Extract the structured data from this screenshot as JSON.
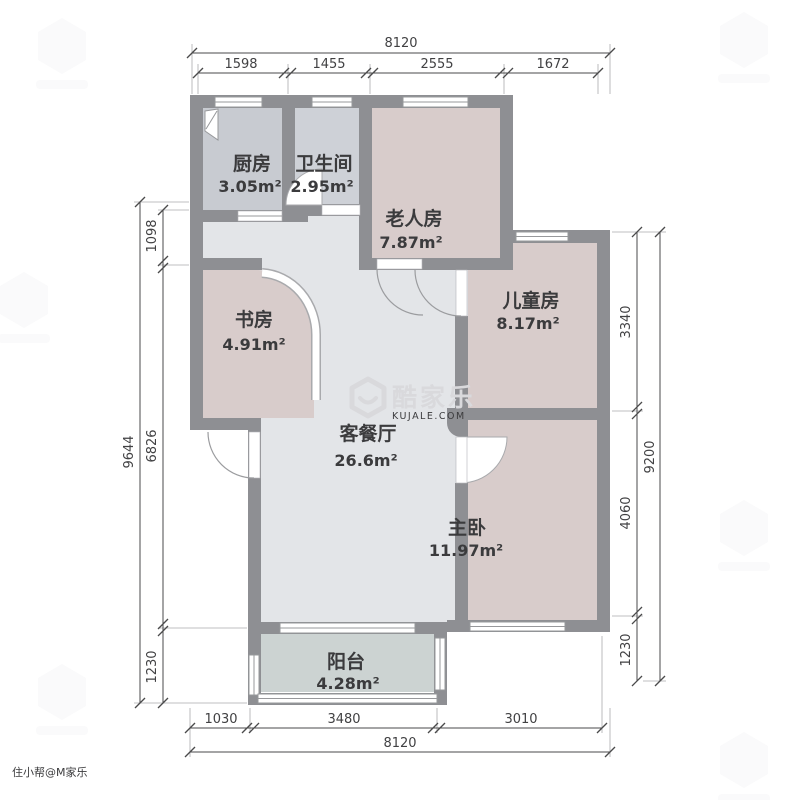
{
  "title": "户型图",
  "rooms": [
    {
      "id": "kitchen",
      "name": "厨房",
      "area": "3.05m²"
    },
    {
      "id": "bathroom",
      "name": "卫生间",
      "area": "2.95m²"
    },
    {
      "id": "elder-room",
      "name": "老人房",
      "area": "7.87m²"
    },
    {
      "id": "kids-room",
      "name": "儿童房",
      "area": "8.17m²"
    },
    {
      "id": "study",
      "name": "书房",
      "area": "4.91m²"
    },
    {
      "id": "living-dining",
      "name": "客餐厅",
      "area": "26.6m²"
    },
    {
      "id": "master-bedroom",
      "name": "主卧",
      "area": "11.97m²"
    },
    {
      "id": "balcony",
      "name": "阳台",
      "area": "4.28m²"
    }
  ],
  "dimensions_mm": {
    "top": {
      "total": "8120",
      "segments": [
        "1598",
        "1455",
        "2555",
        "1672"
      ]
    },
    "bottom": {
      "total": "8120",
      "segments": [
        "1030",
        "3480",
        "3010"
      ]
    },
    "left": {
      "total": "9644",
      "segments": [
        "1098",
        "6826",
        "1230"
      ]
    },
    "right": {
      "total": "9200",
      "segments": [
        "3340",
        "4060",
        "1230"
      ]
    }
  },
  "watermark": {
    "brand": "酷家乐",
    "site": "KUJALE.COM",
    "corner_text": "住小帮@M家乐"
  },
  "colors": {
    "wall": "#8e8f93",
    "floor_living": "#e3e5e8",
    "floor_bedroom": "#d8cccb",
    "floor_kitchen": "#c8cbd1",
    "floor_bath": "#ced1d7",
    "floor_balcony": "#ccd3d2",
    "dimension_text": "#414143",
    "watermark_gray": "#d9d9dc"
  }
}
